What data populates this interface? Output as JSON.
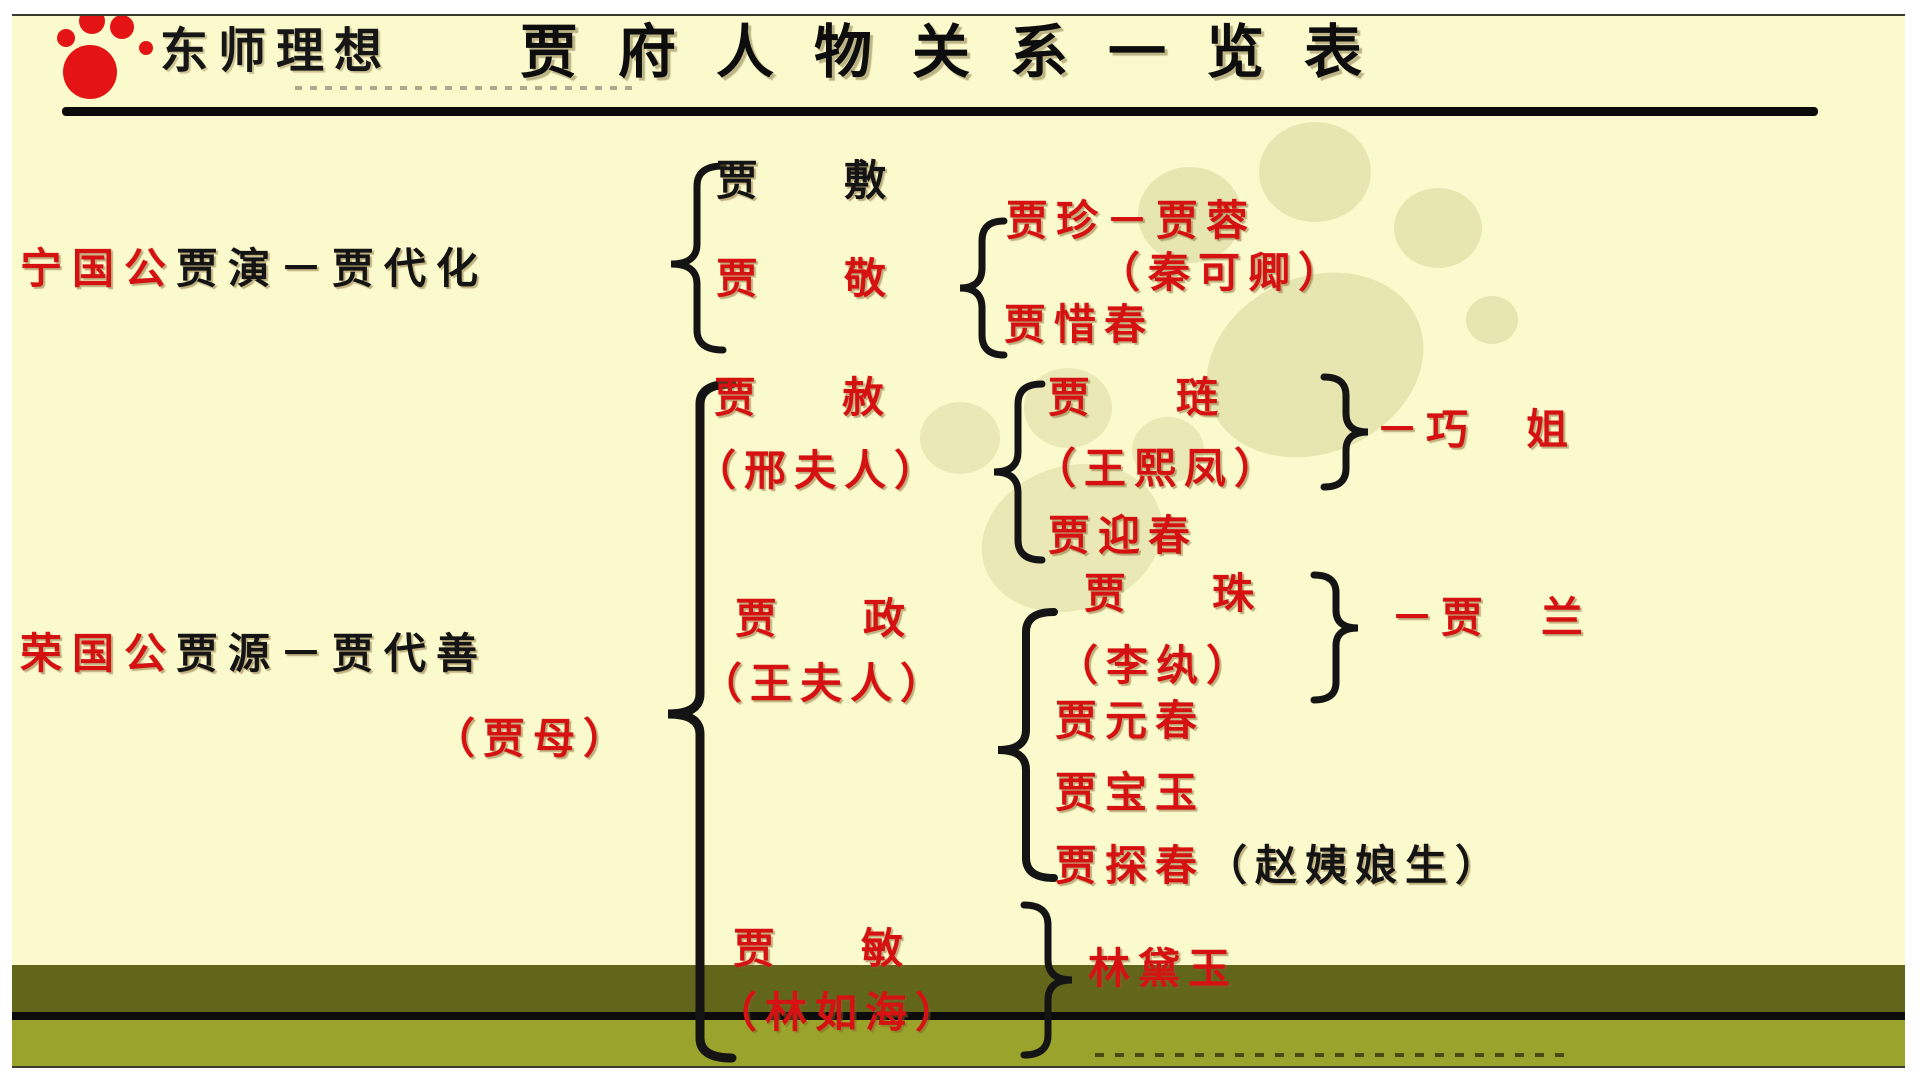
{
  "header": {
    "logo_text": "东师理想",
    "title": "贾府人物关系一览表"
  },
  "ning": {
    "founder_red": "宁国公",
    "founder_black": "贾演－贾代化",
    "jiafu": "贾　敷",
    "jiajing": "贾　敬",
    "jiazhen": "贾珍－贾蓉",
    "qinkeqing": "（秦可卿）",
    "xichun": "贾惜春"
  },
  "rong": {
    "founder_red": "荣国公",
    "founder_black": "贾源－贾代善",
    "jiamu": "（贾母）",
    "jiashe": "贾　赦",
    "xingfuren": "（邢夫人）",
    "jialian": "贾　琏",
    "wangxifeng": "（王熙凤）",
    "qiaojie": "－巧　姐",
    "yingchun": "贾迎春",
    "jiazheng": "贾　政",
    "wangfuren": "（王夫人）",
    "jiazhu": "贾　珠",
    "liwan": "（李纨）",
    "jialan": "－贾　兰",
    "yuanchun": "贾元春",
    "baoyu": "贾宝玉",
    "tanchun": "贾探春",
    "tanchun_note": "（赵姨娘生）",
    "jiamin": "贾　敏",
    "linruhai": "（林如海）",
    "daiyu": "林黛玉"
  },
  "colors": {
    "red": "#d61111",
    "ink": "#141414",
    "background": "#fbfacd",
    "band_dark": "#62661b",
    "band_light": "#9aa32b",
    "logo_red": "#e41414"
  }
}
